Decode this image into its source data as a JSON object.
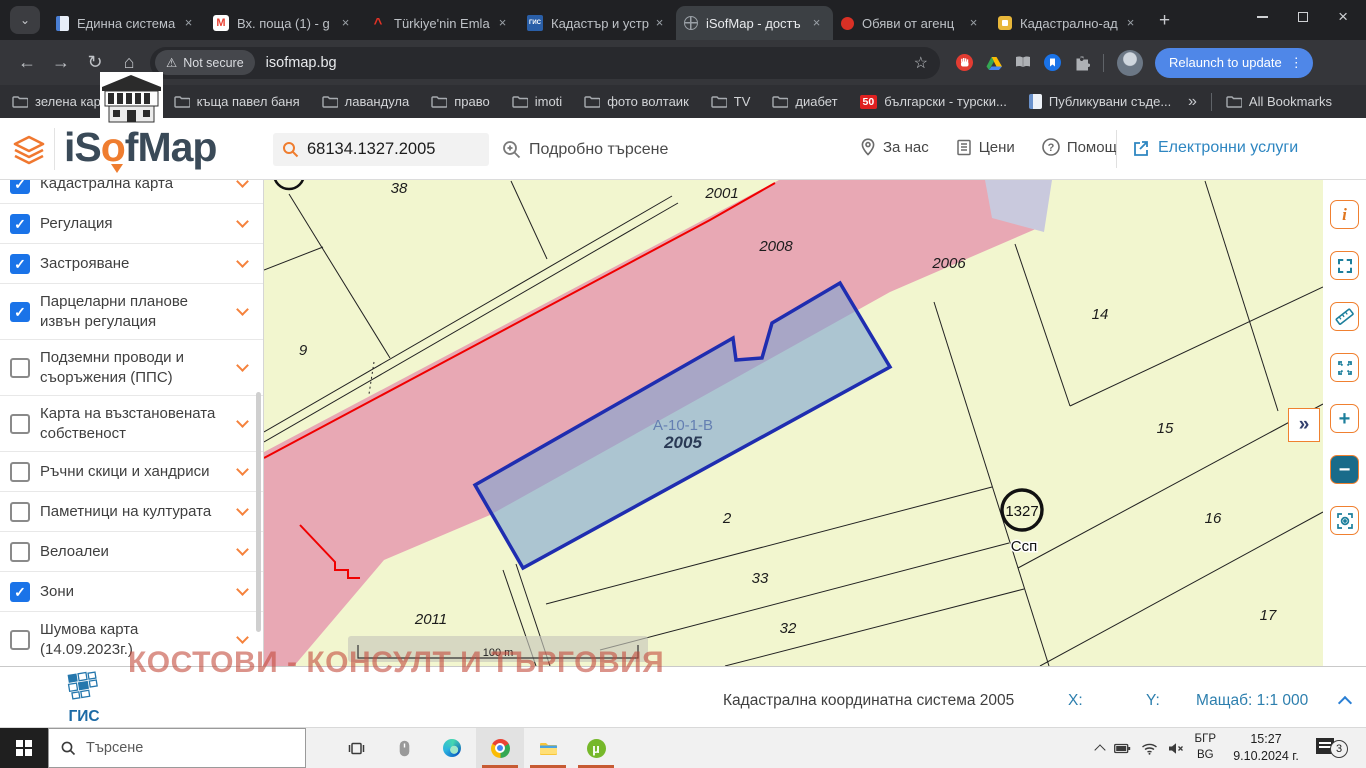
{
  "browser": {
    "tabs": [
      {
        "title": "Единна система",
        "favicon": "doc",
        "active": false
      },
      {
        "title": "Вх. поща (1) - g",
        "favicon": "gmail",
        "active": false
      },
      {
        "title": "Türkiye'nin Emla",
        "favicon": "caret",
        "active": false
      },
      {
        "title": "Кадастър и устр",
        "favicon": "gis",
        "active": false
      },
      {
        "title": "iSofMap - достъ",
        "favicon": "globe",
        "active": true
      },
      {
        "title": "Обяви от агенц",
        "favicon": "dot",
        "active": false
      },
      {
        "title": "Кадастрално-ад",
        "favicon": "shield",
        "active": false
      }
    ],
    "new_tab": "+",
    "nav": {
      "not_secure": "Not secure",
      "url": "isofmap.bg",
      "relaunch": "Relaunch to update",
      "menu_dots": "⋮"
    },
    "bookmarks": {
      "items": [
        {
          "label": "зелена карта",
          "icon": "folder"
        },
        {
          "label": "",
          "icon": "folder"
        },
        {
          "label": "къща павел баня",
          "icon": "folder"
        },
        {
          "label": "лавандула",
          "icon": "folder"
        },
        {
          "label": "право",
          "icon": "folder"
        },
        {
          "label": "imoti",
          "icon": "folder"
        },
        {
          "label": "фото волтаик",
          "icon": "folder"
        },
        {
          "label": "TV",
          "icon": "folder"
        },
        {
          "label": "диабет",
          "icon": "folder"
        },
        {
          "label": "български - турски...",
          "icon": "badge50",
          "badge": "50"
        },
        {
          "label": "Публикувани съде...",
          "icon": "page"
        }
      ],
      "overflow": "»",
      "all": "All Bookmarks"
    }
  },
  "app": {
    "logo_prefix": "iS",
    "logo_o": "o",
    "logo_suffix": "fMap",
    "search_value": "68134.1327.2005",
    "detailed_search": "Подробно търсене",
    "menu": [
      {
        "label": "За нас",
        "icon": "pin"
      },
      {
        "label": "Цени",
        "icon": "list"
      },
      {
        "label": "Помощ",
        "icon": "question"
      }
    ],
    "services": "Електронни услуги"
  },
  "sidebar": {
    "items": [
      {
        "label": "Кадастрална карта",
        "checked": true,
        "two": false
      },
      {
        "label": "Регулация",
        "checked": true,
        "two": false
      },
      {
        "label": "Застрояване",
        "checked": true,
        "two": false
      },
      {
        "label": "Парцеларни планове извън регулация",
        "checked": true,
        "two": true
      },
      {
        "label": "Подземни проводи и съоръжения (ППС)",
        "checked": false,
        "two": true
      },
      {
        "label": "Карта на възстановената собственост",
        "checked": false,
        "two": true
      },
      {
        "label": "Ръчни скици и хандриси",
        "checked": false,
        "two": false
      },
      {
        "label": "Паметници на културата",
        "checked": false,
        "two": false
      },
      {
        "label": "Велоалеи",
        "checked": false,
        "two": false
      },
      {
        "label": "Зони",
        "checked": true,
        "two": false
      },
      {
        "label": "Шумова карта (14.09.2023г.)",
        "checked": false,
        "two": true
      }
    ]
  },
  "map": {
    "labels": [
      {
        "t": "38",
        "x": 129,
        "y": 13,
        "c": "num"
      },
      {
        "t": "2001",
        "x": 452,
        "y": 18,
        "c": "num"
      },
      {
        "t": "2008",
        "x": 506,
        "y": 71,
        "c": "num"
      },
      {
        "t": "2006",
        "x": 679,
        "y": 88,
        "c": "num"
      },
      {
        "t": "9",
        "x": 33,
        "y": 175,
        "c": "num"
      },
      {
        "t": "14",
        "x": 830,
        "y": 139,
        "c": "num"
      },
      {
        "t": "15",
        "x": 895,
        "y": 253,
        "c": "num"
      },
      {
        "t": "А-10-1-В",
        "x": 413,
        "y": 250,
        "c": "code"
      },
      {
        "t": "2005",
        "x": 413,
        "y": 268,
        "c": "selnum"
      },
      {
        "t": "2",
        "x": 457,
        "y": 343,
        "c": "num"
      },
      {
        "t": "16",
        "x": 943,
        "y": 343,
        "c": "num"
      },
      {
        "t": "33",
        "x": 490,
        "y": 403,
        "c": "num"
      },
      {
        "t": "32",
        "x": 518,
        "y": 453,
        "c": "num"
      },
      {
        "t": "2011",
        "x": 161,
        "y": 444,
        "c": "num"
      },
      {
        "t": "17",
        "x": 998,
        "y": 440,
        "c": "num"
      },
      {
        "t": "1327",
        "x": 752,
        "y": 336,
        "c": "pt"
      },
      {
        "t": "Ссп",
        "x": 754,
        "y": 371,
        "c": "halo"
      },
      {
        "t": "100 m",
        "x": 228,
        "y": 476,
        "c": "scale"
      }
    ],
    "toolbar": [
      "info",
      "select-area",
      "measure",
      "fullscreen",
      "zoom-in",
      "zoom-out",
      "locate"
    ],
    "expand": "»",
    "watermark": "КОСТОВИ - КОНСУЛТ И ТЪРГОВИЯ"
  },
  "footer": {
    "brand_bold": "ГИС",
    "brand_light": "София",
    "coord_system": "Кадастрална координатна система 2005",
    "x_label": "X:",
    "y_label": "Y:",
    "scale_label": "Мащаб: 1:1 000"
  },
  "taskbar": {
    "search_placeholder": "Търсене",
    "tray": {
      "lang_top": "БГР",
      "lang_bottom": "BG",
      "time": "15:27",
      "date": "9.10.2024 г.",
      "badge": "3"
    }
  },
  "colors": {
    "accent_orange": "#ef7d2f",
    "check_blue": "#1a73e8",
    "tool_teal": "#1d7f9c",
    "map_bg": "#f2f6cf",
    "map_pink": "#e8a8b4",
    "parcel_stroke": "#1f2db0",
    "parcel_fill": "#7da5cf",
    "regulation_red": "#f00000",
    "watermark_red": "#c34b3c",
    "services_blue": "#2e86c1"
  }
}
